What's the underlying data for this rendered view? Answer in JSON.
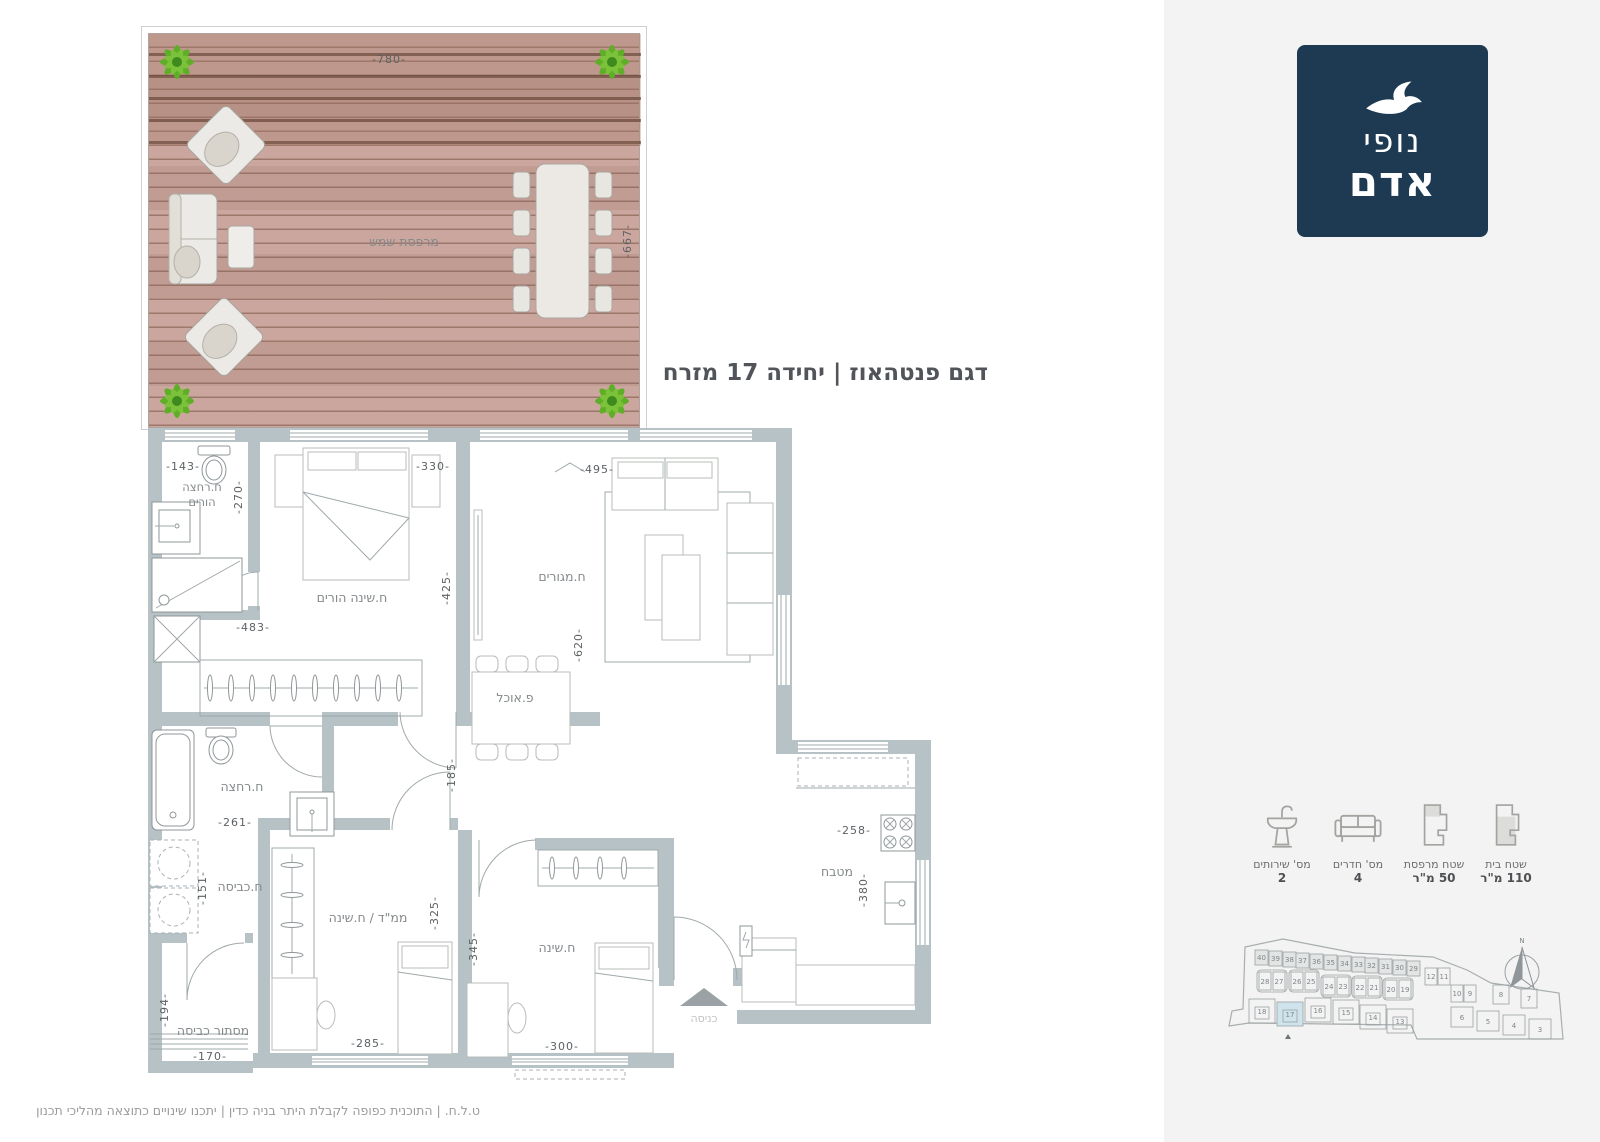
{
  "logo": {
    "line1": "נופי",
    "line2": "אדם",
    "bg": "#1d3a52"
  },
  "title": "דגם פנטהאוז | יחידה 17 מזרח",
  "deck": {
    "label": "מרפסת שמש",
    "dim_top": "-780-",
    "dim_right": "-667-"
  },
  "plan": {
    "rooms": {
      "master_bath_l1": "ח.רחצה",
      "master_bath_l2": "הורים",
      "master_bedroom": "ח.שינה הורים",
      "living": "ח.מגורים",
      "dining": "פ.אוכל",
      "bath2": "ח.רחצה",
      "laundry": "ח.כביסה",
      "laundry_screen": "מסתור כביסה",
      "mamad": "ממ\"ד / ח.שינה",
      "bedroom": "ח.שינה",
      "kitchen": "מטבח",
      "entrance": "כניסה"
    },
    "dims": {
      "d143": "-143-",
      "d270": "-270-",
      "d330": "-330-",
      "d425": "-425-",
      "d483": "-483-",
      "d495": "-495-",
      "d620": "-620-",
      "d185": "-185-",
      "d261": "-261-",
      "d151": "-151-",
      "d325": "-325-",
      "d345": "-345-",
      "d194": "-194-",
      "d170": "-170-",
      "d285": "-285-",
      "d300": "-300-",
      "d258": "-258-",
      "d380": "-380-"
    }
  },
  "legend": {
    "items": [
      {
        "label": "מס' שירותים",
        "value": "2"
      },
      {
        "label": "מס' חדרים",
        "value": "4"
      },
      {
        "label": "שטח מרפסת",
        "value": "50 מ\"ר"
      },
      {
        "label": "שטח בית",
        "value": "110 מ\"ר"
      }
    ]
  },
  "site_plan": {
    "compass": "N",
    "highlight_unit": "17",
    "top_row": [
      "40",
      "39",
      "38",
      "37",
      "36",
      "35",
      "34",
      "33",
      "32",
      "31",
      "30",
      "29"
    ],
    "mid_pairs": [
      "28",
      "27",
      "26",
      "25",
      "24",
      "23",
      "22",
      "21",
      "20",
      "19"
    ],
    "upper_pairs": [
      "12",
      "11",
      "10",
      "9"
    ],
    "bottom_row": [
      "18",
      "17",
      "16",
      "15",
      "14",
      "13"
    ],
    "right_units": [
      "8",
      "7",
      "6",
      "5",
      "4",
      "3"
    ]
  },
  "footer": "ט.ל.ח.  |  התוכנית כפופה לקבלת היתר בניה כדין  |  יתכנו שינויים כתוצאה מהליכי תכנון"
}
